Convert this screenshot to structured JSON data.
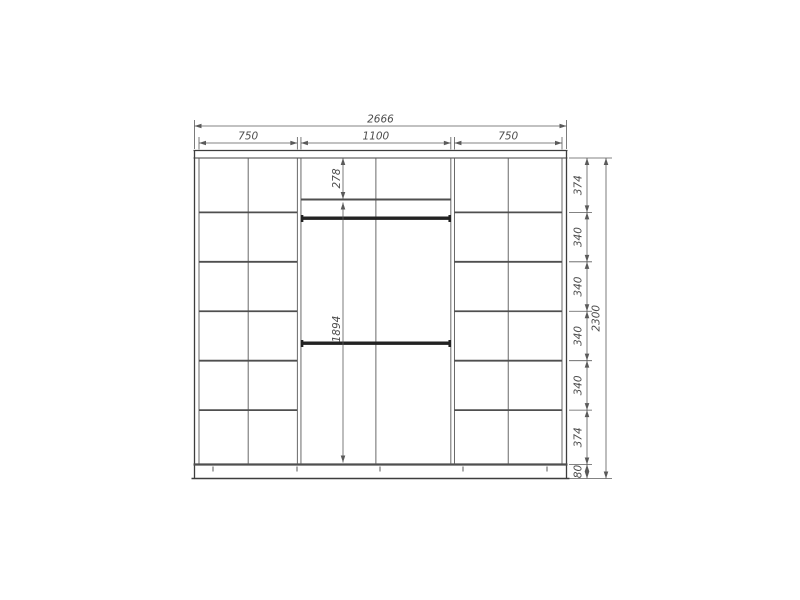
{
  "meta": {
    "drawing_type": "wardrobe front elevation technical drawing",
    "units": "mm"
  },
  "palette": {
    "background": "#ffffff",
    "frame_line": "#3d3d3d",
    "inner_line": "#585858",
    "shelf_line": "#4f4f4f",
    "rod_fill": "#222222",
    "dim_line": "#5a5a5a",
    "dim_text": "#4c4c4c"
  },
  "overall": {
    "width": {
      "label": "2666",
      "value_mm": 2666
    },
    "height": {
      "label": "2300",
      "value_mm": 2300
    }
  },
  "top_sections": [
    {
      "name": "left-section-width",
      "label": "750",
      "value_mm": 750
    },
    {
      "name": "middle-section-width",
      "label": "1100",
      "value_mm": 1100
    },
    {
      "name": "right-section-width",
      "label": "750",
      "value_mm": 750
    }
  ],
  "right_segments": [
    {
      "name": "row-1-height",
      "label": "374",
      "value_mm": 374
    },
    {
      "name": "row-2-height",
      "label": "340",
      "value_mm": 340
    },
    {
      "name": "row-3-height",
      "label": "340",
      "value_mm": 340
    },
    {
      "name": "row-4-height",
      "label": "340",
      "value_mm": 340
    },
    {
      "name": "row-5-height",
      "label": "340",
      "value_mm": 340
    },
    {
      "name": "row-6-height",
      "label": "374",
      "value_mm": 374
    },
    {
      "name": "plinth-height",
      "label": "80",
      "value_mm": 80
    }
  ],
  "middle_dims": {
    "top_shelf": {
      "name": "middle-top-compartment",
      "label": "278",
      "value_mm": 278
    },
    "hanging_space": {
      "name": "middle-hanging-space",
      "label": "1894",
      "value_mm": 1894
    }
  },
  "structure": {
    "left_section": {
      "rows": 6,
      "columns": 2
    },
    "right_section": {
      "rows": 6,
      "columns": 2
    },
    "middle_section": {
      "hanging_rods": 2,
      "center_divider": true,
      "top_shelf": true
    },
    "base_legs": 5
  }
}
